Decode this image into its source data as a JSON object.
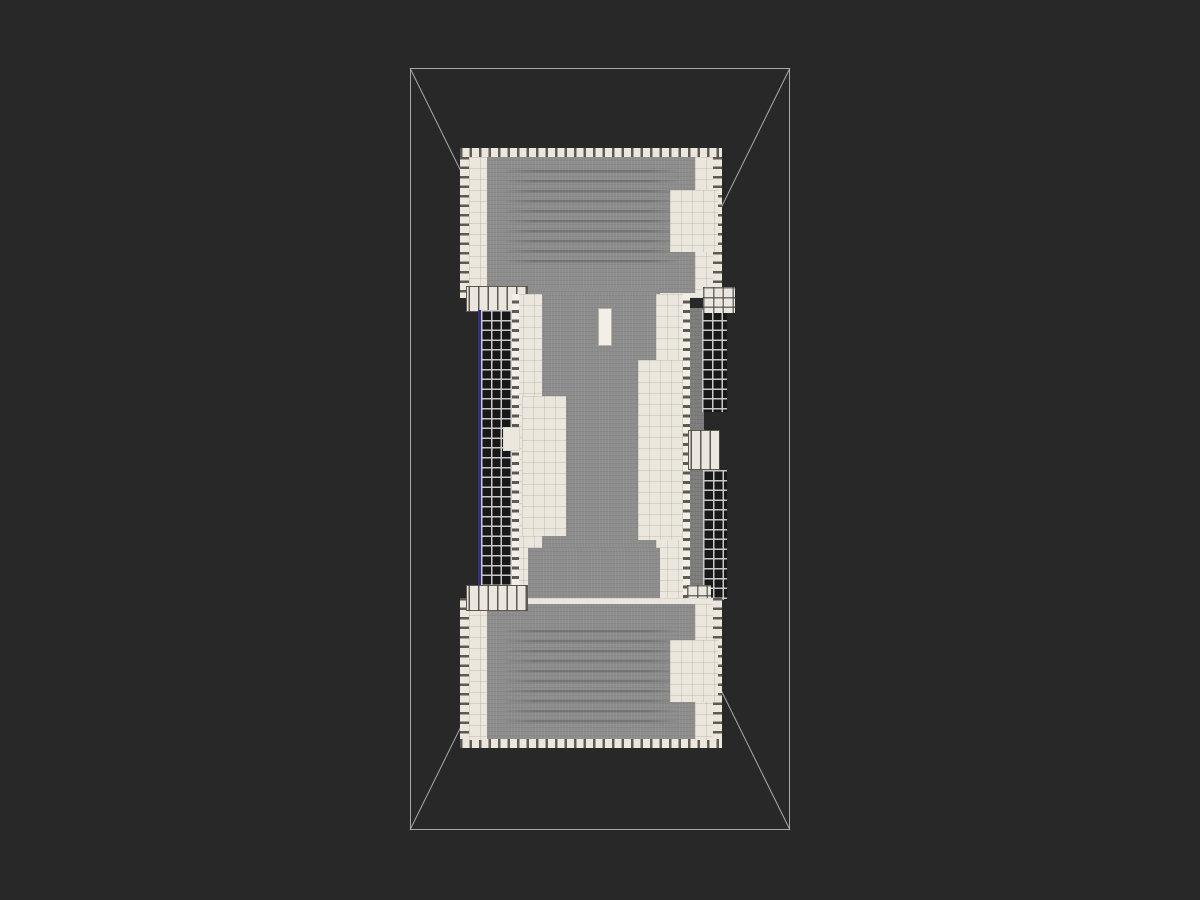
{
  "scene": {
    "description": "top-down-structure-render",
    "viewport": {
      "width": 1200,
      "height": 900
    },
    "colors": {
      "background": "#282828",
      "wireframe": "#a8a8a8",
      "cream": "#ebe7de",
      "cream_bright": "#f2efe8",
      "cream_line": "#b0a88f59",
      "tick": "#48443cdd",
      "stone": "#8d8d8d",
      "stone_dark": "#7d7d7d",
      "row_line": "#5e5e5e80",
      "glass_bg": "#181818",
      "glass_line": "#c9c9c9",
      "blue_accent": "#32327a"
    },
    "wireframe_box": {
      "outer": {
        "x": 410,
        "y": 68,
        "w": 380,
        "h": 762
      },
      "inner": {
        "x": 479,
        "y": 208,
        "w": 242,
        "h": 482
      }
    },
    "parts": [
      {
        "name": "hall-top-base",
        "x": 460,
        "y": 148,
        "w": 262,
        "h": 150,
        "cls": "cream"
      },
      {
        "name": "hall-top-roof",
        "x": 487,
        "y": 157,
        "w": 208,
        "h": 136,
        "cls": "stone"
      },
      {
        "name": "hall-top-seat-rows",
        "x": 503,
        "y": 170,
        "w": 176,
        "h": 98,
        "cls": "roofrows"
      },
      {
        "name": "hall-top-cren-top",
        "x": 460,
        "y": 148,
        "w": 262,
        "h": 9,
        "cls": "cren-x"
      },
      {
        "name": "hall-top-cren-left",
        "x": 460,
        "y": 157,
        "w": 9,
        "h": 141,
        "cls": "cren-y"
      },
      {
        "name": "hall-top-cren-right",
        "x": 713,
        "y": 157,
        "w": 9,
        "h": 141,
        "cls": "cren-y"
      },
      {
        "name": "hall-top-wall-left",
        "x": 469,
        "y": 157,
        "w": 18,
        "h": 136,
        "cls": "tiles"
      },
      {
        "name": "hall-top-wall-right",
        "x": 695,
        "y": 157,
        "w": 18,
        "h": 136,
        "cls": "tiles"
      },
      {
        "name": "hall-top-tower",
        "x": 670,
        "y": 190,
        "w": 48,
        "h": 62,
        "cls": "tiles"
      },
      {
        "name": "nave-shoulder-top",
        "x": 528,
        "y": 288,
        "w": 132,
        "h": 60,
        "cls": "stone"
      },
      {
        "name": "nave-roof",
        "x": 542,
        "y": 290,
        "w": 116,
        "h": 318,
        "cls": "stone"
      },
      {
        "name": "stud-block-top-left",
        "x": 466,
        "y": 286,
        "w": 62,
        "h": 26,
        "cls": "studs"
      },
      {
        "name": "courtyard-grid-left",
        "x": 481,
        "y": 310,
        "w": 31,
        "h": 282,
        "cls": "glassgrid"
      },
      {
        "name": "blue-marker-line",
        "x": 478,
        "y": 310,
        "w": 3,
        "h": 282,
        "cls": "bluefill"
      },
      {
        "name": "aisle-wall-left",
        "x": 512,
        "y": 294,
        "w": 30,
        "h": 306,
        "cls": "tiles"
      },
      {
        "name": "aisle-merlons-left",
        "x": 512,
        "y": 294,
        "w": 7,
        "h": 306,
        "cls": "merlon-y"
      },
      {
        "name": "transept-plaza-left",
        "x": 522,
        "y": 396,
        "w": 44,
        "h": 140,
        "cls": "tiles"
      },
      {
        "name": "transept-tip-left",
        "x": 503,
        "y": 427,
        "w": 17,
        "h": 24,
        "cls": "cream"
      },
      {
        "name": "skylight-top",
        "x": 598,
        "y": 308,
        "w": 14,
        "h": 38,
        "cls": "skylight"
      },
      {
        "name": "skylight-bottom",
        "x": 598,
        "y": 551,
        "w": 14,
        "h": 37,
        "cls": "skylight"
      },
      {
        "name": "aisle-wall-right",
        "x": 656,
        "y": 294,
        "w": 34,
        "h": 306,
        "cls": "tiles"
      },
      {
        "name": "transept-plaza-right",
        "x": 638,
        "y": 360,
        "w": 50,
        "h": 180,
        "cls": "tiles"
      },
      {
        "name": "aisle-merlons-right",
        "x": 683,
        "y": 294,
        "w": 7,
        "h": 306,
        "cls": "merlon-y"
      },
      {
        "name": "gallery-strip-right",
        "x": 690,
        "y": 308,
        "w": 14,
        "h": 284,
        "cls": "stone-dark"
      },
      {
        "name": "courtyard-grid-right-upper",
        "x": 702,
        "y": 310,
        "w": 25,
        "h": 102,
        "cls": "glassgrid"
      },
      {
        "name": "gallery-cap-right-upper",
        "x": 703,
        "y": 287,
        "w": 32,
        "h": 26,
        "cls": "glasswhite"
      },
      {
        "name": "transept-tip-right",
        "x": 688,
        "y": 430,
        "w": 32,
        "h": 40,
        "cls": "studs"
      },
      {
        "name": "courtyard-grid-right-lower",
        "x": 703,
        "y": 470,
        "w": 24,
        "h": 130,
        "cls": "glassgrid"
      },
      {
        "name": "gallery-cap-right-lower",
        "x": 687,
        "y": 585,
        "w": 24,
        "h": 24,
        "cls": "glasswhite"
      },
      {
        "name": "nave-shoulder-bottom",
        "x": 528,
        "y": 548,
        "w": 132,
        "h": 60,
        "cls": "stone"
      },
      {
        "name": "hall-bottom-base",
        "x": 460,
        "y": 598,
        "w": 262,
        "h": 150,
        "cls": "cream"
      },
      {
        "name": "hall-bottom-roof",
        "x": 487,
        "y": 604,
        "w": 208,
        "h": 136,
        "cls": "stone"
      },
      {
        "name": "hall-bottom-seat-rows",
        "x": 503,
        "y": 630,
        "w": 176,
        "h": 98,
        "cls": "roofrows"
      },
      {
        "name": "hall-bottom-cren-bottom",
        "x": 460,
        "y": 739,
        "w": 262,
        "h": 9,
        "cls": "cren-x"
      },
      {
        "name": "hall-bottom-cren-left",
        "x": 460,
        "y": 598,
        "w": 9,
        "h": 141,
        "cls": "cren-y"
      },
      {
        "name": "hall-bottom-cren-right",
        "x": 713,
        "y": 598,
        "w": 9,
        "h": 141,
        "cls": "cren-y"
      },
      {
        "name": "hall-bottom-wall-left",
        "x": 469,
        "y": 604,
        "w": 18,
        "h": 136,
        "cls": "tiles"
      },
      {
        "name": "hall-bottom-wall-right",
        "x": 695,
        "y": 604,
        "w": 18,
        "h": 136,
        "cls": "tiles"
      },
      {
        "name": "hall-bottom-tower",
        "x": 670,
        "y": 640,
        "w": 48,
        "h": 62,
        "cls": "tiles"
      },
      {
        "name": "stud-block-bottom-left",
        "x": 466,
        "y": 585,
        "w": 62,
        "h": 26,
        "cls": "studs"
      }
    ]
  }
}
